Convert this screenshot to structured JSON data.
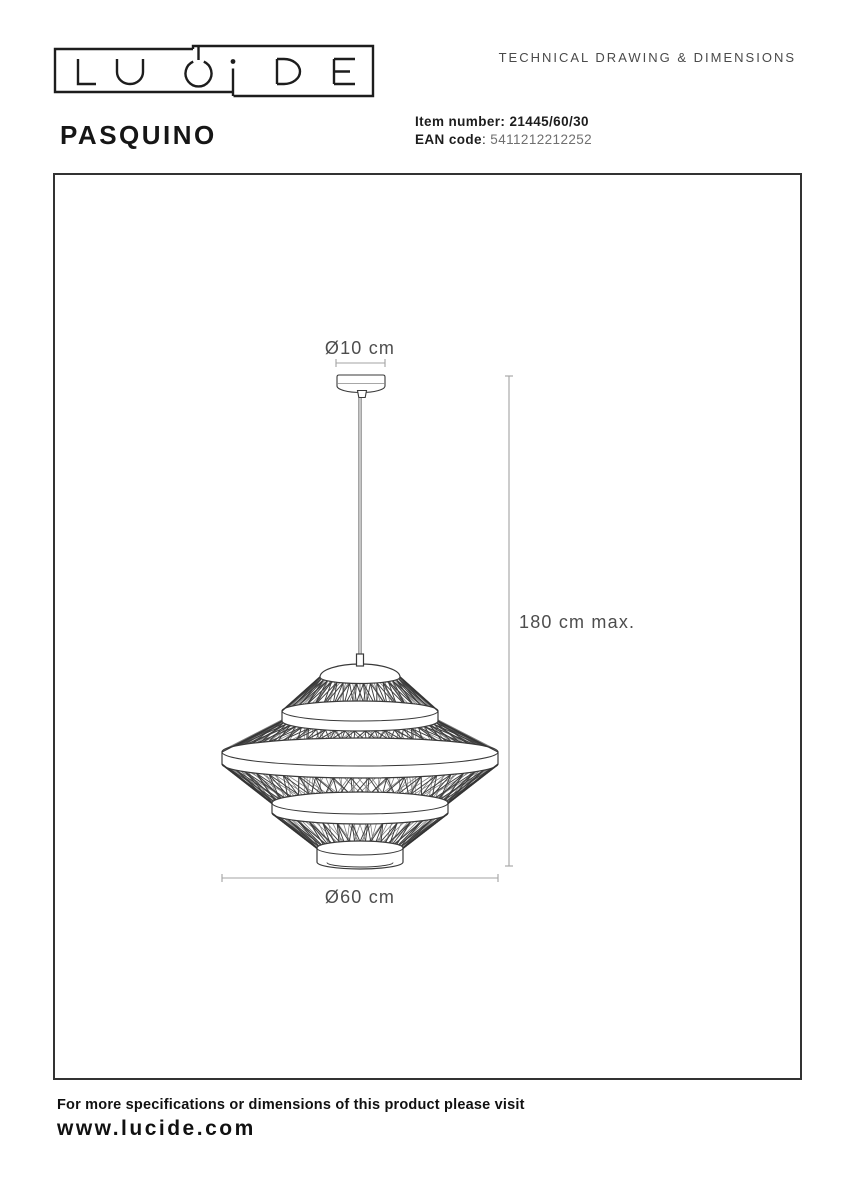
{
  "header": {
    "logo_text": "LUCIDE",
    "doc_title": "TECHNICAL DRAWING & DIMENSIONS"
  },
  "product": {
    "name": "PASQUINO",
    "item_number_label": "Item number:",
    "item_number": "21445/60/30",
    "ean_label": "EAN code",
    "ean_colon": ":",
    "ean": "5411212212252"
  },
  "drawing": {
    "canopy_diameter_label": "Ø10 cm",
    "height_label": "180 cm max.",
    "diameter_label": "Ø60 cm"
  },
  "footer": {
    "note": "For more specifications or dimensions of this product please visit",
    "website": "www.lucide.com"
  },
  "colors": {
    "ink": "#1d1d1d",
    "muted_text": "#4d4d4d",
    "dimension_line": "#a3a3a3",
    "drawing_stroke": "#3a3a3a",
    "spoke_front": "#3d3d3d",
    "spoke_back": "#7d7d7d",
    "inner_rod": "#999999",
    "ean_value": "#6f6f6f"
  }
}
